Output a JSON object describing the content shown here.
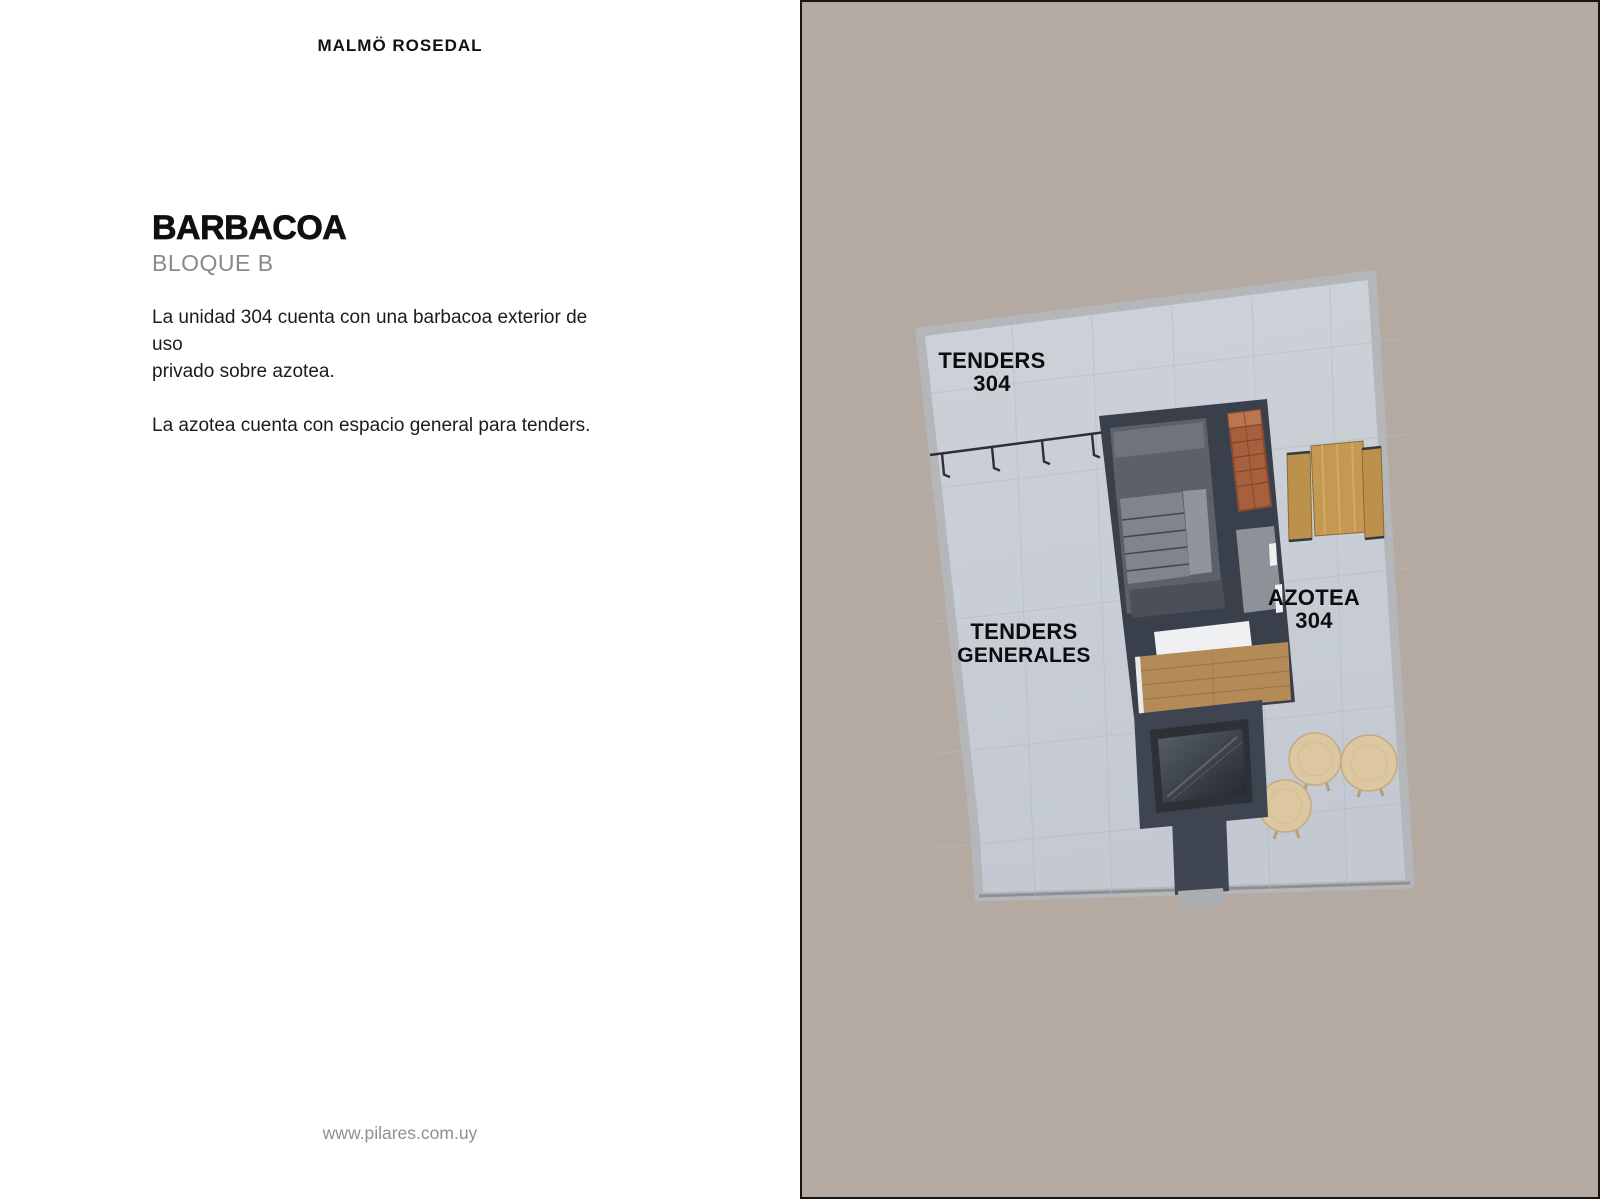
{
  "left": {
    "brand": "MALMÖ ROSEDAL",
    "title": "BARBACOA",
    "subtitle": "BLOQUE B",
    "paragraph1_lines": [
      "La unidad 304 cuenta con una barbacoa exterior de uso",
      "privado sobre azotea."
    ],
    "paragraph2": "La azotea cuenta con espacio general para tenders.",
    "footer_url": "www.pilares.com.uy"
  },
  "plan": {
    "labels": {
      "tenders_unit": {
        "line1": "TENDERS",
        "line2": "304"
      },
      "tenders_general": {
        "line1": "TENDERS",
        "line2": "GENERALES"
      },
      "azotea": {
        "line1": "AZOTEA",
        "line2": "304"
      }
    },
    "colors": {
      "panel_background": "#b4aaa2",
      "panel_border": "#151515",
      "roof_floor": "#cbd0d8",
      "parapet": "#b4b6b9",
      "walls_dark": "#3a404b",
      "deck_wood": "#b48b57",
      "brick_grill": "#a8603c",
      "table_wood": "#c49a52",
      "stool": "#dcc7a1",
      "label_text": "#0d0d0d"
    }
  }
}
